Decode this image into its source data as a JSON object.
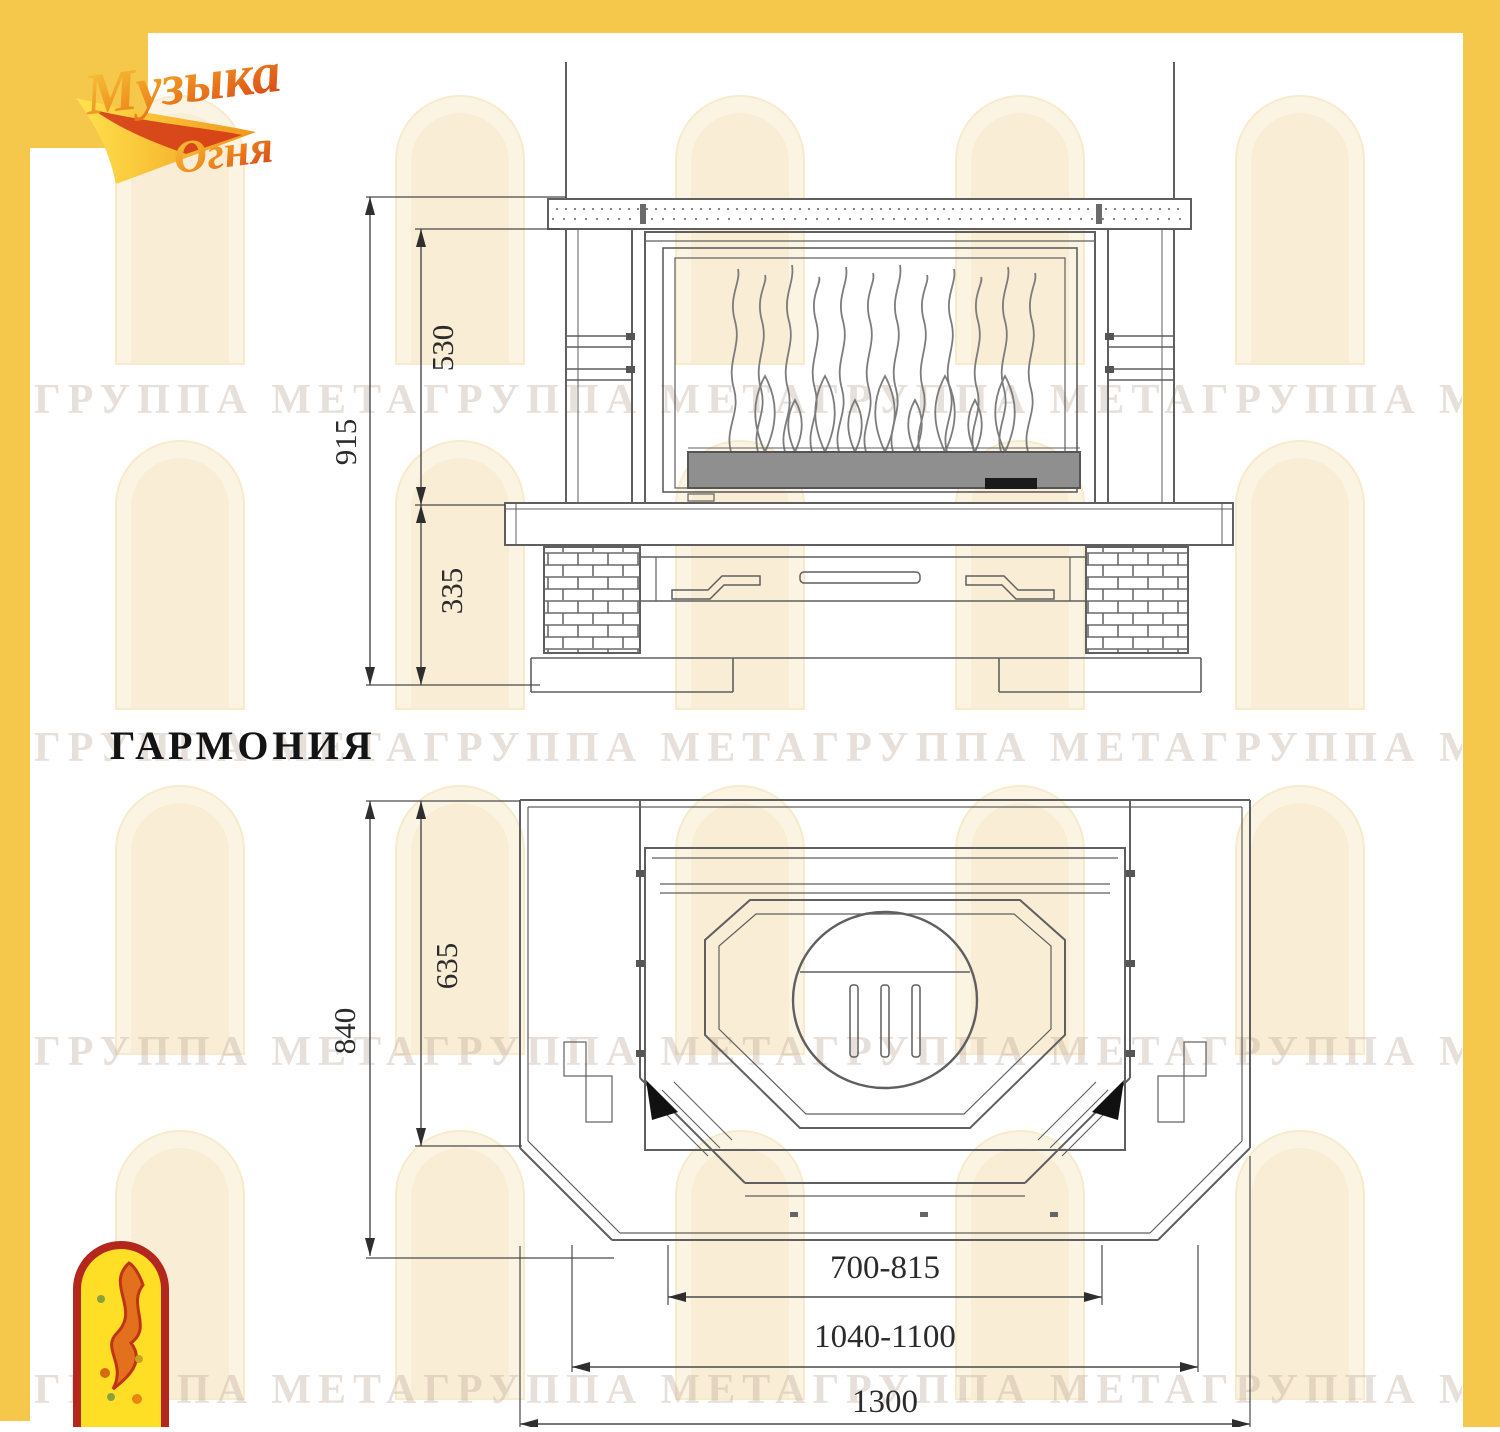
{
  "page": {
    "frame_color": "#F5C74B",
    "background": "#ffffff"
  },
  "logo": {
    "line1": "Музыка",
    "line2": "Огня"
  },
  "title": "ГАРМОНИЯ",
  "watermark_text": "ГРУППА МЕТАГРУППА МЕТАГРУППА МЕТАГРУППА МЕТАГРУППА МЕТА",
  "front_view": {
    "dim_total_height": "915",
    "dim_firebox_height": "530",
    "dim_base_height": "335"
  },
  "plan_view": {
    "dim_total_depth": "840",
    "dim_body_depth": "635",
    "dim_firebox_width": "700-815",
    "dim_portal_width": "1040-1100",
    "dim_total_width": "1300"
  }
}
